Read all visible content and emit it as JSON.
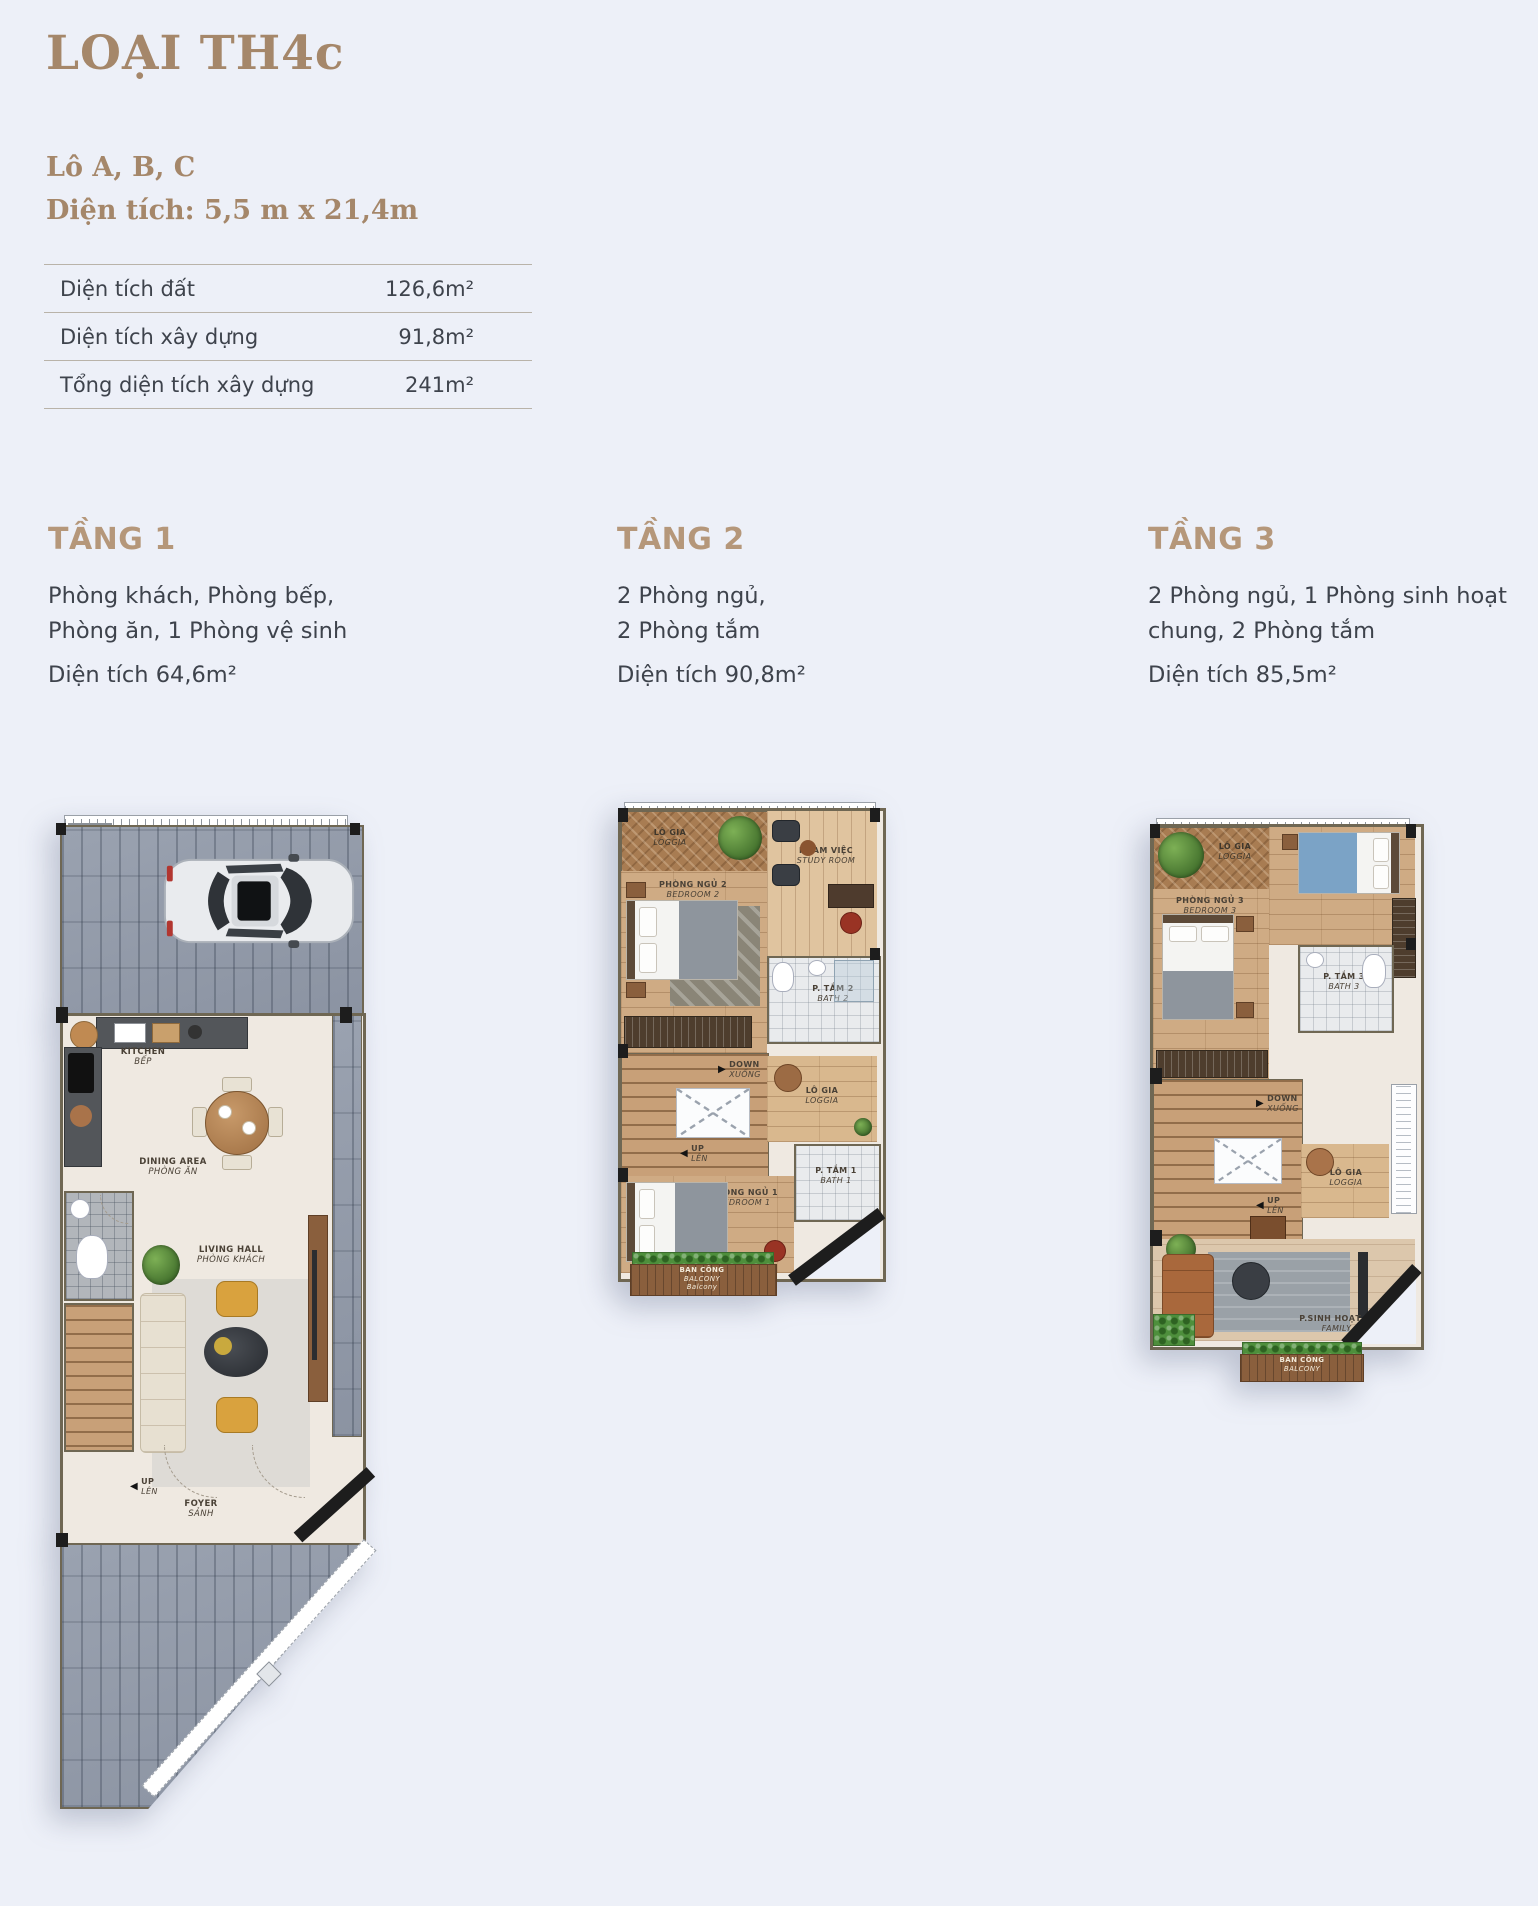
{
  "page": {
    "title": "LOẠI TH4c",
    "lot": "Lô A, B, C",
    "size": "Diện tích: 5,5 m x 21,4m"
  },
  "area_table": {
    "rows": [
      {
        "label": "Diện tích đất",
        "value": "126,6m²"
      },
      {
        "label": "Diện tích xây dựng",
        "value": "91,8m²"
      },
      {
        "label": "Tổng diện tích xây dựng",
        "value": "241m²"
      }
    ]
  },
  "floors": [
    {
      "name": "TẦNG 1",
      "line1": "Phòng khách, Phòng bếp,",
      "line2": "Phòng ăn, 1 Phòng vệ sinh",
      "area": "Diện tích 64,6m²"
    },
    {
      "name": "TẦNG 2",
      "line1": "2 Phòng ngủ,",
      "line2": "2 Phòng tắm",
      "area": "Diện tích 90,8m²"
    },
    {
      "name": "TẦNG 3",
      "line1": "2 Phòng ngủ, 1 Phòng sinh hoạt",
      "line2": "chung, 2 Phòng tắm",
      "area": "Diện tích 85,5m²"
    }
  ],
  "icons": {
    "up_arrow": "◀",
    "down_arrow": "▶"
  },
  "plan1": {
    "kitchen": {
      "l1": "KITCHEN",
      "l2": "BẾP"
    },
    "dining": {
      "l1": "DINING AREA",
      "l2": "PHÒNG ĂN"
    },
    "living": {
      "l1": "LIVING HALL",
      "l2": "PHÒNG KHÁCH"
    },
    "up": {
      "l1": "UP",
      "l2": "LÊN"
    },
    "foyer": {
      "l1": "FOYER",
      "l2": "SẢNH"
    }
  },
  "plan2": {
    "loggia_top": {
      "l1": "LÔ GIA",
      "l2": "LOGGIA"
    },
    "study": {
      "l1": "P.LÀM VIỆC",
      "l2": "STUDY ROOM"
    },
    "bedroom2": {
      "l1": "PHÒNG NGỦ 2",
      "l2": "BEDROOM 2"
    },
    "bath2": {
      "l1": "P. TẮM 2",
      "l2": "BATH 2"
    },
    "down": {
      "l1": "DOWN",
      "l2": "XUỐNG"
    },
    "up": {
      "l1": "UP",
      "l2": "LÊN"
    },
    "loggia_right": {
      "l1": "LÔ GIA",
      "l2": "LOGGIA"
    },
    "bedroom1": {
      "l1": "PHÒNG NGỦ 1",
      "l2": "BEDROOM 1"
    },
    "bath1": {
      "l1": "P. TẮM 1",
      "l2": "BATH 1"
    },
    "balcony": {
      "l1": "BAN CÔNG",
      "l2": "BALCONY",
      "l3": "Balcony"
    }
  },
  "plan3": {
    "loggia_top": {
      "l1": "LÔ GIA",
      "l2": "LOGGIA"
    },
    "bedroom3": {
      "l1": "PHÒNG NGỦ 3",
      "l2": "BEDROOM 3"
    },
    "bedroom4": {
      "l1": "PHÒNG NGỦ 4",
      "l2": "BEDROOM 4"
    },
    "bath3": {
      "l1": "P. TẮM 3",
      "l2": "BATH 3"
    },
    "down": {
      "l1": "DOWN",
      "l2": "XUỐNG"
    },
    "up": {
      "l1": "UP",
      "l2": "LÊN"
    },
    "loggia_right": {
      "l1": "LÔ GIA",
      "l2": "LOGGIA"
    },
    "family": {
      "l1": "P.SINH HOẠT CHUNG",
      "l2": "FAMILY HALL"
    },
    "balcony": {
      "l1": "BAN CÔNG",
      "l2": "BALCONY"
    }
  },
  "colors": {
    "accent_brown": "#a5876a",
    "heading_brown": "#b5977a",
    "body_text": "#3e434c",
    "background": "#edf0f8"
  }
}
